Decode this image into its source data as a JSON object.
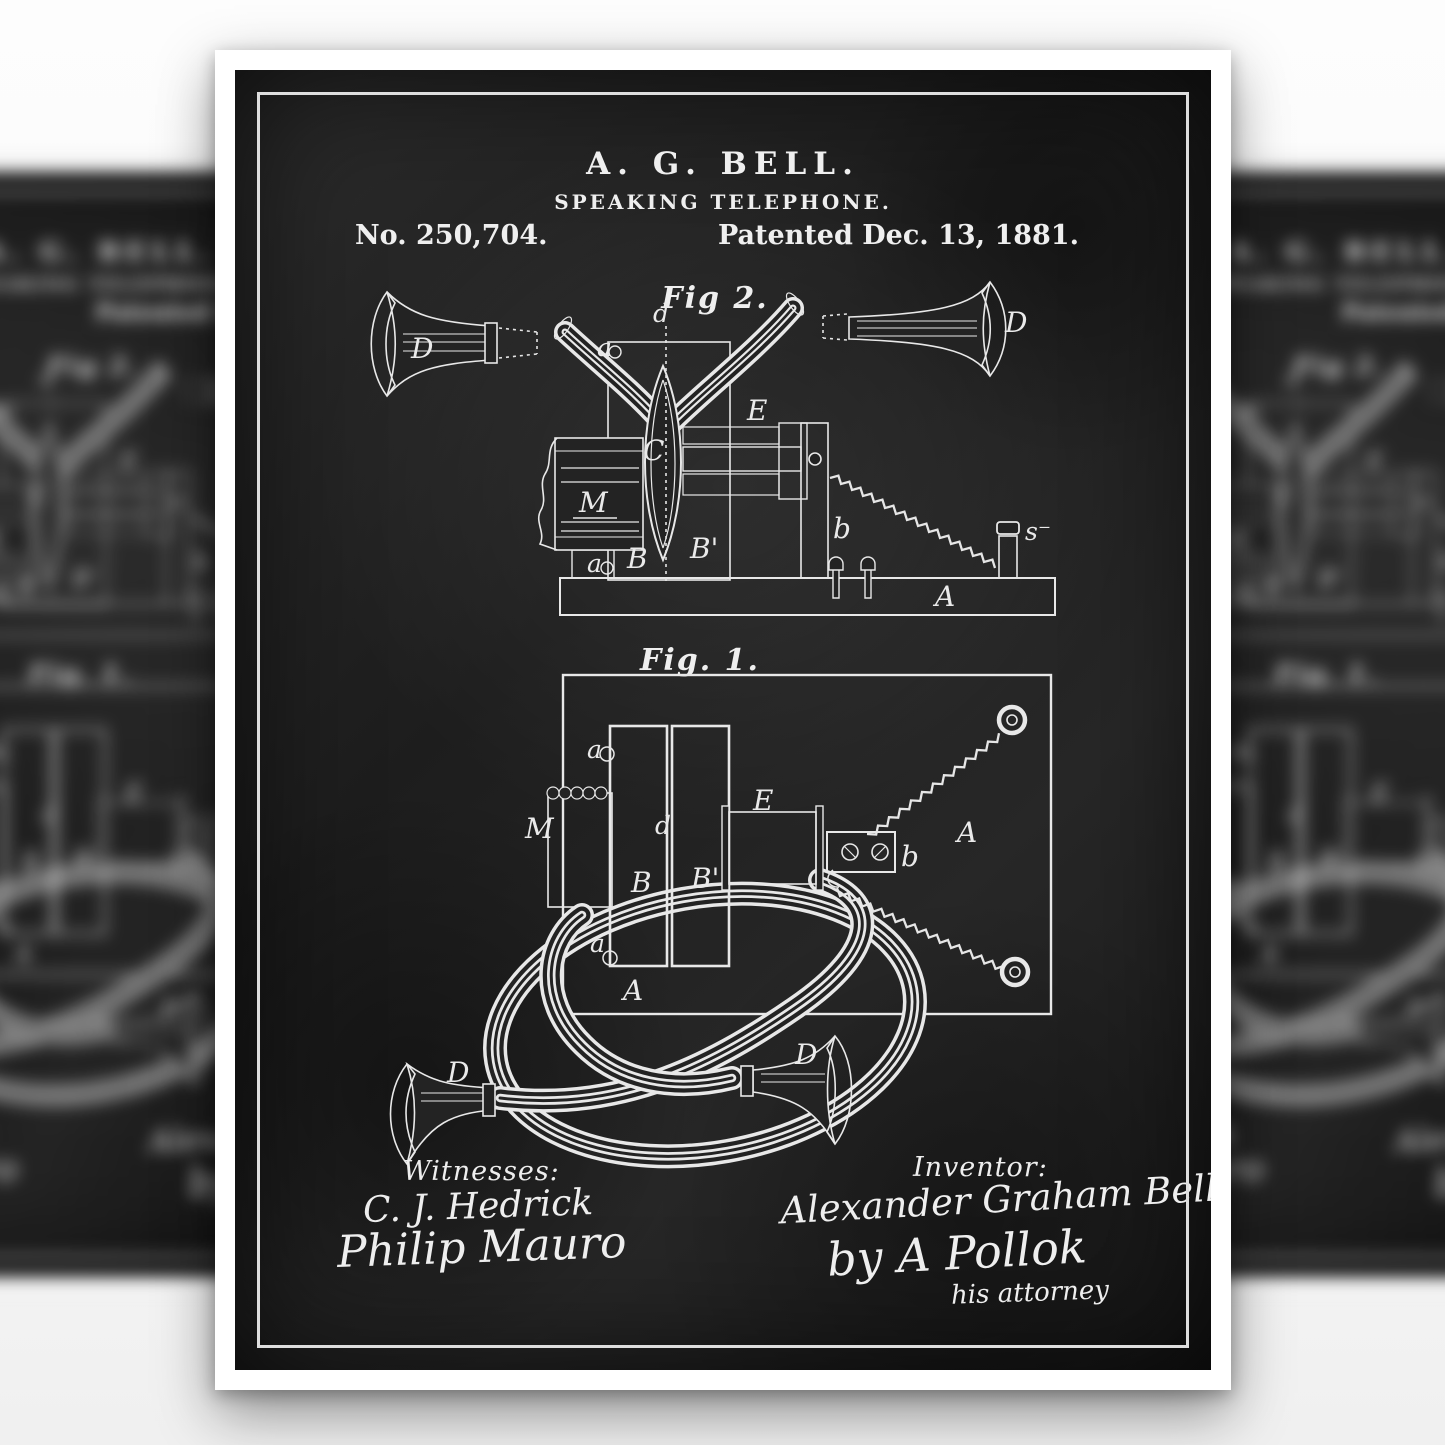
{
  "poster": {
    "header": {
      "inventor": "A. G. BELL.",
      "title": "SPEAKING TELEPHONE.",
      "patent_number": "No. 250,704.",
      "patent_date": "Patented Dec. 13, 1881."
    },
    "figure2": {
      "title": "Fig 2.",
      "labels": {
        "horn_left": "D",
        "horn_right": "D",
        "diaphragm_edge": "d",
        "top_screw": "a",
        "bottom_screw": "a",
        "diaphragm": "C",
        "mouthpiece_block": "M",
        "electromagnet": "E",
        "leg_left": "B",
        "leg_right": "B'",
        "support": "b",
        "binding_post": "s⁻",
        "base": "A"
      }
    },
    "figure1": {
      "title": "Fig. 1.",
      "labels": {
        "top_screw": "a",
        "bottom_screw": "a",
        "mouthpiece_coil": "M",
        "diaphragm_edge": "d",
        "electromagnet": "E",
        "bar_left": "B",
        "bar_right": "B'",
        "junction_block": "b",
        "base_plate": "A",
        "base_corner": "A",
        "horn_left": "D",
        "horn_right": "D"
      }
    },
    "signatures": {
      "witnesses_heading": "Witnesses:",
      "witness_1": "C. J. Hedrick",
      "witness_2": "Philip Mauro",
      "inventor_heading": "Inventor:",
      "inventor_signature": "Alexander Graham Bell",
      "attorney_by_line": "by  A Pollok",
      "attorney_title": "his attorney"
    }
  },
  "colors": {
    "page_background": "#f9f9f9",
    "paper": "#ffffff",
    "chalkboard": "#232323",
    "line_art": "#e8e8e8"
  }
}
